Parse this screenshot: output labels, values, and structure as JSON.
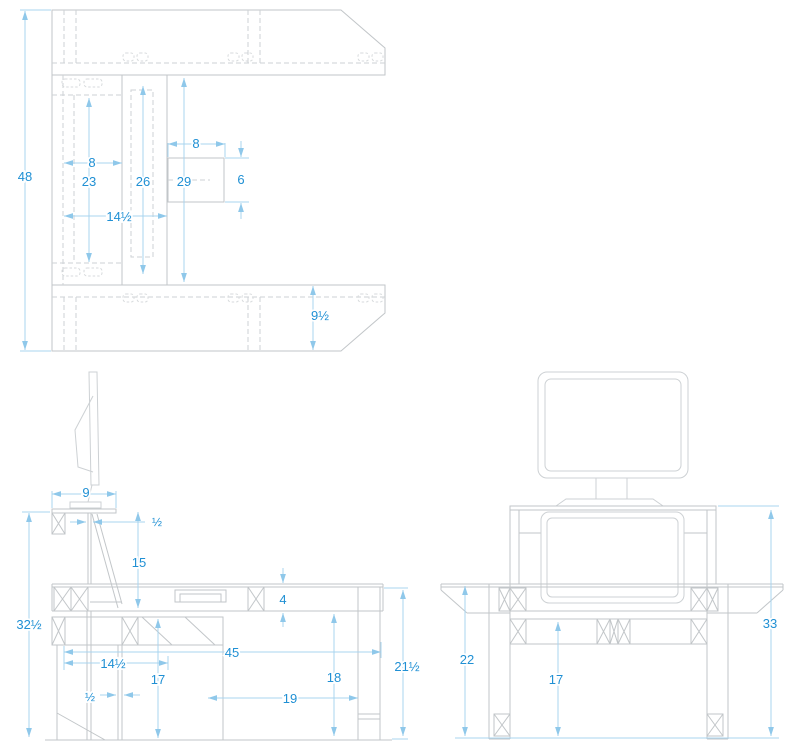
{
  "drawing": {
    "type": "furniture technical drawing",
    "colors": {
      "background": "#ffffff",
      "object_line": "#c2c6c9",
      "hidden_line": "#ced2d5",
      "dimension_line": "#a8d4ef",
      "dimension_text": "#2090d4"
    },
    "views": {
      "top_view": {
        "dimensions": [
          {
            "id": "overall-width",
            "label": "48"
          },
          {
            "id": "inner-panel-offset",
            "label": "8"
          },
          {
            "id": "box-width",
            "label": "8"
          },
          {
            "id": "panel-length-a",
            "label": "23"
          },
          {
            "id": "panel-length-b",
            "label": "26"
          },
          {
            "id": "panel-length-c",
            "label": "29"
          },
          {
            "id": "box-depth",
            "label": "6"
          },
          {
            "id": "center-section-depth",
            "label": "14½"
          },
          {
            "id": "wing-width",
            "label": "9½"
          }
        ]
      },
      "side_view": {
        "dimensions": [
          {
            "id": "shelf-depth",
            "label": "9"
          },
          {
            "id": "shelf-thickness",
            "label": "½"
          },
          {
            "id": "shelf-riser-height",
            "label": "15"
          },
          {
            "id": "overall-height",
            "label": "32½"
          },
          {
            "id": "front-section-depth",
            "label": "14½"
          },
          {
            "id": "overall-depth",
            "label": "45"
          },
          {
            "id": "stretcher-height",
            "label": "17"
          },
          {
            "id": "panel-thickness",
            "label": "½"
          },
          {
            "id": "apron-height",
            "label": "4"
          },
          {
            "id": "underside-clearance",
            "label": "18"
          },
          {
            "id": "leg-spacing",
            "label": "19"
          },
          {
            "id": "desktop-clearance",
            "label": "21½"
          }
        ]
      },
      "front_view": {
        "dimensions": [
          {
            "id": "wing-height",
            "label": "22"
          },
          {
            "id": "stretcher-height",
            "label": "17"
          },
          {
            "id": "shelf-top-height",
            "label": "33"
          }
        ]
      }
    }
  }
}
